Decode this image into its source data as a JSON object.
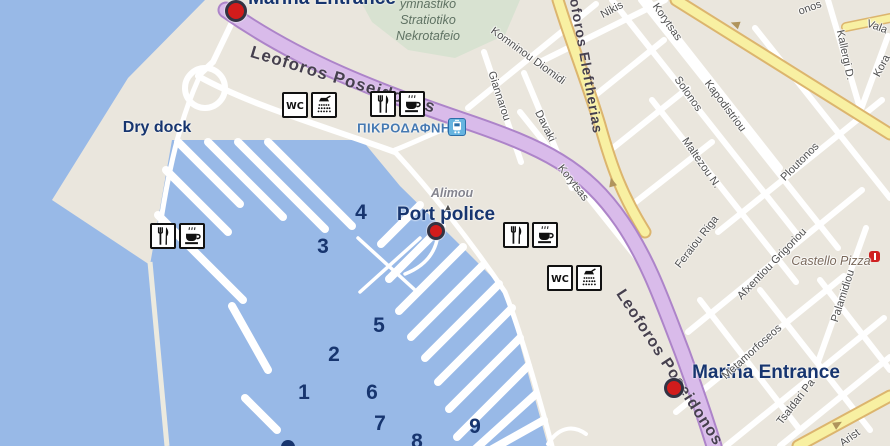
{
  "map": {
    "colors": {
      "water": "#98b9e7",
      "land": "#eae6dd",
      "green_area": "#d8e2d1",
      "road_purple": "#d9bbea",
      "road_purple_casing": "#ad84c9",
      "road_yellow": "#f8f0a2",
      "road_yellow_casing": "#dcb56e",
      "road_white": "#ffffff",
      "marker_red": "#d21c1c",
      "label_navy": "#17356f",
      "street_grey": "#4e4e4e",
      "station_blue": "#4579b2"
    },
    "labels": {
      "marina_entrance_top": "Marina Entrance",
      "marina_entrance_bottom": "Marina Entrance",
      "port_police": "Port police",
      "dry_dock": "Dry dock",
      "station": "ΠΙΚΡΟΔΑΦΝΗ",
      "cemetery": [
        "ymnastiko",
        "Stratiotiko",
        "Nekrotafeio"
      ]
    },
    "pier_numbers": [
      {
        "n": "1",
        "x": 304,
        "y": 393
      },
      {
        "n": "2",
        "x": 334,
        "y": 355
      },
      {
        "n": "3",
        "x": 323,
        "y": 247
      },
      {
        "n": "4",
        "x": 361,
        "y": 213
      },
      {
        "n": "5",
        "x": 379,
        "y": 326
      },
      {
        "n": "6",
        "x": 372,
        "y": 393
      },
      {
        "n": "7",
        "x": 380,
        "y": 424
      },
      {
        "n": "8",
        "x": 417,
        "y": 442
      },
      {
        "n": "9",
        "x": 475,
        "y": 427
      }
    ],
    "street_labels": [
      {
        "t": "Leoforos Poseidonos",
        "x": 343,
        "y": 80,
        "a": 17,
        "s": 17,
        "c": "onroad"
      },
      {
        "t": "Leoforos Eleftherias",
        "x": 585,
        "y": 57,
        "a": 80,
        "s": 14,
        "c": "onroad"
      },
      {
        "t": "Leoforos Poseidonos",
        "x": 669,
        "y": 368,
        "a": 57,
        "s": 16,
        "c": "onroad"
      },
      {
        "t": "Nikis",
        "x": 612,
        "y": 10,
        "a": -28,
        "s": 11,
        "c": "st"
      },
      {
        "t": "Komninou Diomidi",
        "x": 528,
        "y": 56,
        "a": 36,
        "s": 11,
        "c": "st"
      },
      {
        "t": "Giannarou",
        "x": 499,
        "y": 96,
        "a": 72,
        "s": 11,
        "c": "st"
      },
      {
        "t": "Davaki",
        "x": 545,
        "y": 126,
        "a": 64,
        "s": 11,
        "c": "st"
      },
      {
        "t": "Korytsas",
        "x": 573,
        "y": 183,
        "a": 52,
        "s": 11,
        "c": "st"
      },
      {
        "t": "Korytsas",
        "x": 667,
        "y": 22,
        "a": 55,
        "s": 11,
        "c": "st"
      },
      {
        "t": "Solonos",
        "x": 688,
        "y": 94,
        "a": 55,
        "s": 11,
        "c": "st"
      },
      {
        "t": "Kapodistriou",
        "x": 725,
        "y": 106,
        "a": 53,
        "s": 11,
        "c": "st"
      },
      {
        "t": "Maltezou N.",
        "x": 701,
        "y": 163,
        "a": 55,
        "s": 11,
        "c": "st"
      },
      {
        "t": "Ploutonos",
        "x": 800,
        "y": 162,
        "a": -45,
        "s": 11,
        "c": "st"
      },
      {
        "t": "Feraiou Riga",
        "x": 697,
        "y": 242,
        "a": -52,
        "s": 11,
        "c": "st"
      },
      {
        "t": "Afxentiou Grigoriou",
        "x": 772,
        "y": 264,
        "a": -46,
        "s": 11,
        "c": "st"
      },
      {
        "t": "Metamorfoseos",
        "x": 752,
        "y": 352,
        "a": -42,
        "s": 11,
        "c": "st"
      },
      {
        "t": "Tsaldari Pa",
        "x": 796,
        "y": 402,
        "a": -52,
        "s": 11,
        "c": "st"
      },
      {
        "t": "Palamidiou",
        "x": 843,
        "y": 296,
        "a": -72,
        "s": 11,
        "c": "st"
      },
      {
        "t": "Kallergi D.",
        "x": 845,
        "y": 55,
        "a": 78,
        "s": 11,
        "c": "st"
      },
      {
        "t": "Vala",
        "x": 877,
        "y": 27,
        "a": 20,
        "s": 11,
        "c": "st"
      },
      {
        "t": "Kora",
        "x": 882,
        "y": 66,
        "a": -62,
        "s": 11,
        "c": "st"
      },
      {
        "t": "onos",
        "x": 810,
        "y": 8,
        "a": -20,
        "s": 11,
        "c": "st"
      },
      {
        "t": "Arist",
        "x": 850,
        "y": 438,
        "a": -36,
        "s": 11,
        "c": "st"
      },
      {
        "t": "Alimou",
        "x": 452,
        "y": 193,
        "a": 0,
        "s": 12.5,
        "c": "area"
      },
      {
        "t": "Castello Pizza",
        "x": 831,
        "y": 261,
        "a": 0,
        "s": 12.5,
        "c": "poi"
      },
      {
        "t": "▲",
        "x": 448,
        "y": 207,
        "a": 0,
        "s": 9,
        "c": "st"
      }
    ],
    "amenity_groups": [
      {
        "x": 282,
        "y": 92,
        "icons": [
          "wc",
          "shower"
        ]
      },
      {
        "x": 370,
        "y": 91,
        "icons": [
          "restaurant",
          "coffee"
        ]
      },
      {
        "x": 150,
        "y": 223,
        "icons": [
          "restaurant",
          "coffee"
        ]
      },
      {
        "x": 503,
        "y": 222,
        "icons": [
          "restaurant",
          "coffee"
        ]
      },
      {
        "x": 547,
        "y": 265,
        "icons": [
          "wc",
          "shower"
        ]
      }
    ],
    "markers": [
      {
        "name": "marina-entrance-top-marker",
        "x": 236,
        "y": 11,
        "r": 11
      },
      {
        "name": "port-police-marker",
        "x": 436,
        "y": 231,
        "r": 9
      },
      {
        "name": "marina-entrance-bottom-marker",
        "x": 674,
        "y": 388,
        "r": 10
      }
    ],
    "road_arrows": [
      {
        "x": 735,
        "y": 24,
        "a": 200
      },
      {
        "x": 612,
        "y": 182,
        "a": 255
      },
      {
        "x": 838,
        "y": 424,
        "a": 330
      }
    ]
  }
}
